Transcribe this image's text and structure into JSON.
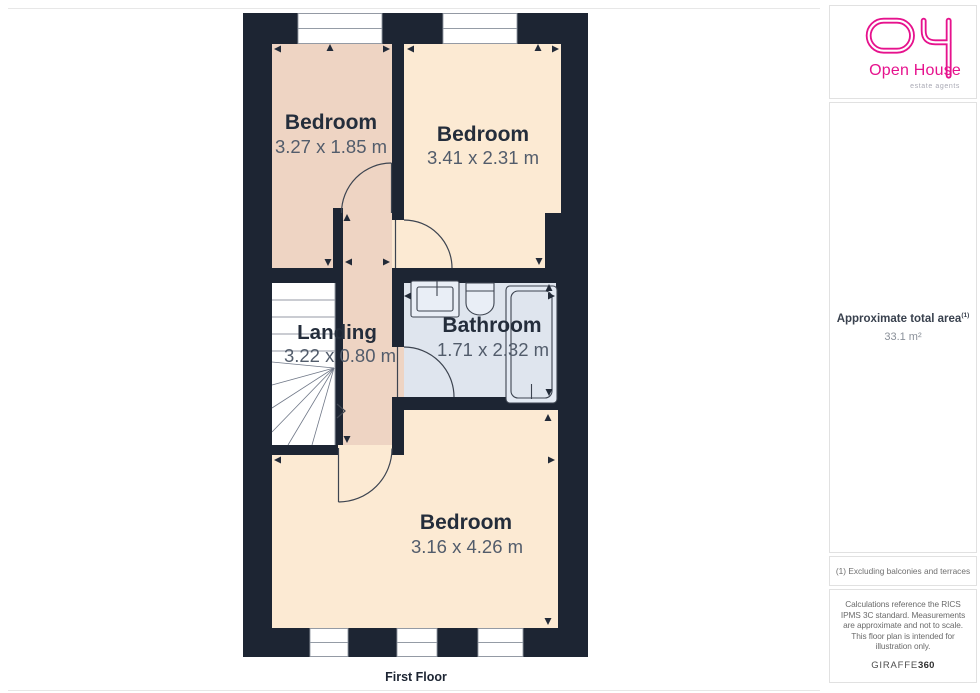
{
  "floor_plan": {
    "floor_label": "First Floor",
    "rooms": [
      {
        "label": "Bedroom",
        "dims": "3.27 x 1.85 m"
      },
      {
        "label": "Bedroom",
        "dims": "3.41 x 2.31 m"
      },
      {
        "label": "Landing",
        "dims": "3.22 x 0.80 m"
      },
      {
        "label": "Bathroom",
        "dims": "1.71 x 2.32 m"
      },
      {
        "label": "Bedroom",
        "dims": "3.16 x 4.26 m"
      }
    ],
    "colors": {
      "wall": "#1d2533",
      "warm_floor": "#eed4c3",
      "cream_floor": "#fcead3",
      "bathroom_floor": "#dfe5ee",
      "stairs": "#ffffff"
    }
  },
  "sidebar": {
    "logo": {
      "brand": "Open House",
      "tagline": "estate agents",
      "color": "#e6128d"
    },
    "area": {
      "label": "Approximate total area",
      "footnote_ref": "(1)",
      "value": "33.1 m²"
    },
    "footnote": "(1) Excluding balconies and terraces",
    "disclaimer": "Calculations reference the RICS IPMS 3C standard. Measurements are approximate and not to scale. This floor plan is intended for illustration only.",
    "brand_mark": {
      "name": "GIRAFFE",
      "suffix": "360"
    }
  }
}
